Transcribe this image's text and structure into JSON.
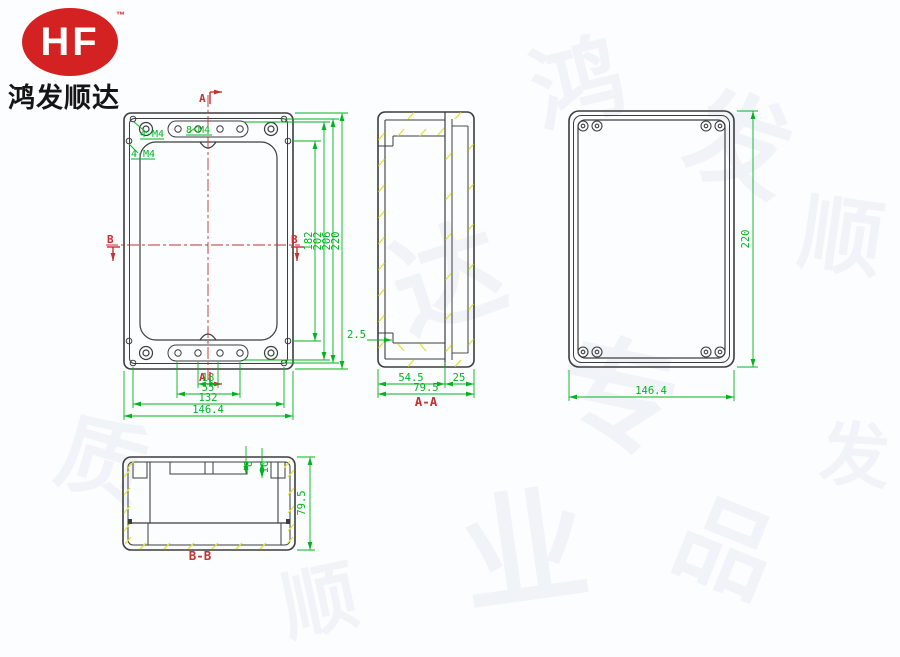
{
  "logo": {
    "brand": "HF",
    "tm": "™",
    "company": "鸿发顺达"
  },
  "front": {
    "marker_a": "A",
    "marker_b": "B",
    "leaders": [
      "4-M4",
      "4-M4",
      "8-M4"
    ],
    "right_dims": [
      "182",
      "202",
      "206",
      "220"
    ],
    "bottom_dims": [
      "18",
      "55",
      "132",
      "146.4"
    ]
  },
  "aa": {
    "title": "A-A",
    "step": "2.5",
    "body": "54.5",
    "lid": "25",
    "total": "79.5"
  },
  "rear": {
    "height": "220",
    "width": "146.4"
  },
  "bb": {
    "title": "B-B",
    "d_small": "8",
    "d_large": "10",
    "total": "79.5"
  },
  "colors": {
    "line": "#3d3d3d",
    "dimension": "#00b41e",
    "section_mark": "#c53030",
    "hatch": "#e3e332",
    "logo_red": "#d42121"
  },
  "watermark": [
    "鸿",
    "发",
    "顺",
    "达",
    "专",
    "业",
    "品",
    "质",
    "顺",
    "发"
  ]
}
